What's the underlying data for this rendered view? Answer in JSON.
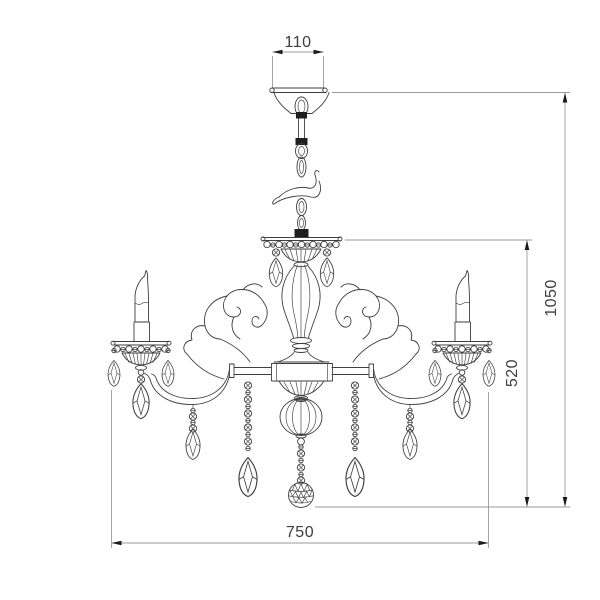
{
  "meta": {
    "title": "Chandelier technical dimension drawing",
    "units_shown": false
  },
  "dimensions": {
    "canopy_width": "110",
    "fixture_width": "750",
    "body_height": "520",
    "total_height": "1050"
  },
  "drawing": {
    "parts": [
      "ceiling-canopy",
      "suspension-chain",
      "crown-bobeche",
      "center-column",
      "center-hub",
      "melon-sphere",
      "bead-chain",
      "faceted-ball-finial",
      "left-arm",
      "right-arm",
      "left-candle",
      "right-candle",
      "crystal-pendants",
      "scroll-ornaments"
    ]
  },
  "colors": {
    "line": "#3f3f3f",
    "band": "#1e1e1e",
    "dimline": "#9a9a9a",
    "arrow": "#1a1a1a",
    "dimtext": "#3d3d3d",
    "bg": "#ffffff"
  }
}
